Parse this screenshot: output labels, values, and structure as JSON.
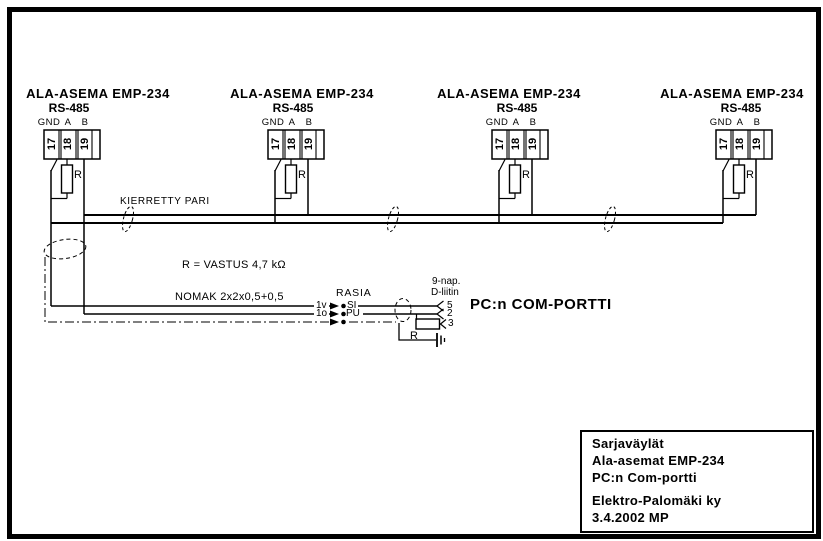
{
  "colors": {
    "ink": "#000000",
    "paper": "#ffffff"
  },
  "diagram": {
    "stations": [
      {
        "title": "ALA-ASEMA EMP-234",
        "interface": "RS-485",
        "signals": [
          "GND",
          "A",
          "B"
        ],
        "terminals": [
          "17",
          "18",
          "19"
        ],
        "resistor": "R"
      },
      {
        "title": "ALA-ASEMA EMP-234",
        "interface": "RS-485",
        "signals": [
          "GND",
          "A",
          "B"
        ],
        "terminals": [
          "17",
          "18",
          "19"
        ],
        "resistor": "R"
      },
      {
        "title": "ALA-ASEMA EMP-234",
        "interface": "RS-485",
        "signals": [
          "GND",
          "A",
          "B"
        ],
        "terminals": [
          "17",
          "18",
          "19"
        ],
        "resistor": "R"
      },
      {
        "title": "ALA-ASEMA EMP-234",
        "interface": "RS-485",
        "signals": [
          "GND",
          "A",
          "B"
        ],
        "terminals": [
          "17",
          "18",
          "19"
        ],
        "resistor": "R"
      }
    ],
    "bus": {
      "label": "KIERRETTY PARI",
      "note_resistor": "R = VASTUS 4,7 kΩ",
      "note_cable": "NOMAK 2x2x0,5+0,5"
    },
    "rasia": {
      "title": "RASIA",
      "inputs": [
        "1v",
        "1o"
      ],
      "terminals": [
        "SI",
        "PU"
      ]
    },
    "pc": {
      "connector": [
        "9-nap.",
        "D-liitin"
      ],
      "pins": [
        "5",
        "2",
        "3"
      ],
      "resistor": "R",
      "port": "PC:n COM-PORTTI"
    },
    "title_block": {
      "lines": [
        "Sarjaväylät",
        "Ala-asemat EMP-234",
        "PC:n Com-portti",
        "Elektro-Palomäki ky",
        "3.4.2002 MP"
      ]
    }
  }
}
